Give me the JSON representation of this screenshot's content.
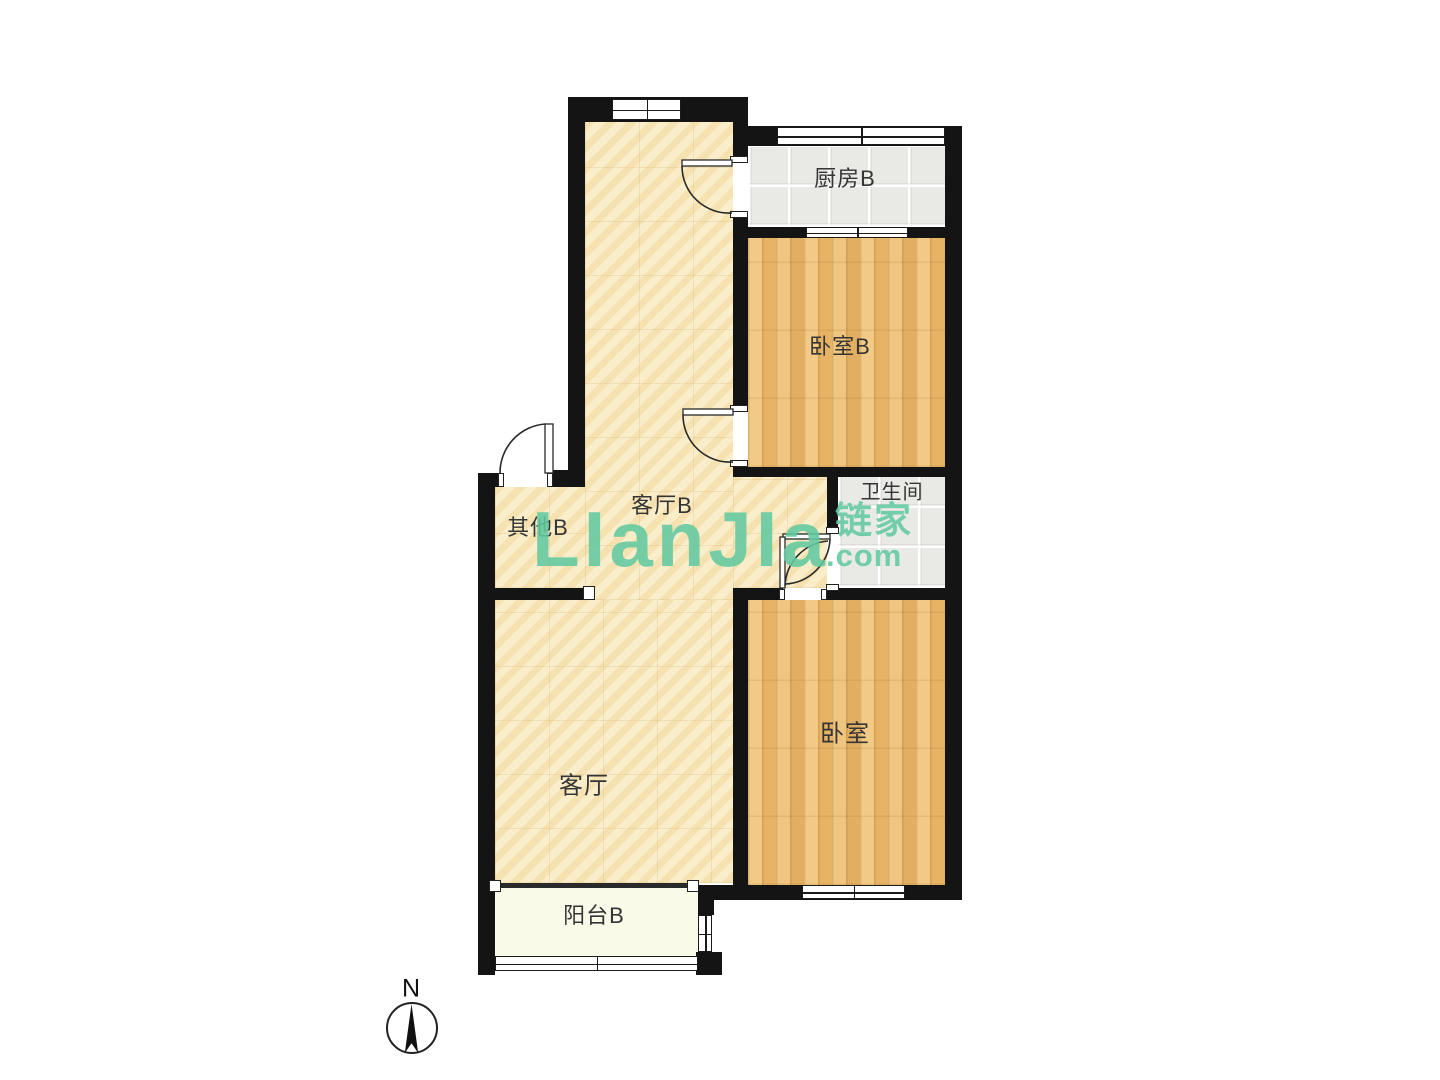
{
  "plan": {
    "type": "residential floor plan",
    "orientation_note": "north arrow points up"
  },
  "rooms": [
    {
      "id": "kitchen-b",
      "label": "厨房B"
    },
    {
      "id": "bedroom-b",
      "label": "卧室B"
    },
    {
      "id": "bathroom",
      "label": "卫生间"
    },
    {
      "id": "hall-b",
      "label": "客厅B"
    },
    {
      "id": "other-b",
      "label": "其他B"
    },
    {
      "id": "living-room",
      "label": "客厅"
    },
    {
      "id": "bedroom",
      "label": "卧室"
    },
    {
      "id": "balcony-b",
      "label": "阳台B"
    }
  ],
  "watermark": {
    "brand": "LIanJIa",
    "brand_cn": "链家",
    "suffix": ".com",
    "color": "#5EC8A1"
  },
  "compass": {
    "label": "N"
  },
  "colors": {
    "wall": "#141414",
    "floor_beige": "#F7EBC6",
    "floor_wood": "#ECBC6E",
    "floor_tile": "#E9E9E6",
    "floor_balcony": "#FAFAE8",
    "background": "#FFFFFF"
  }
}
